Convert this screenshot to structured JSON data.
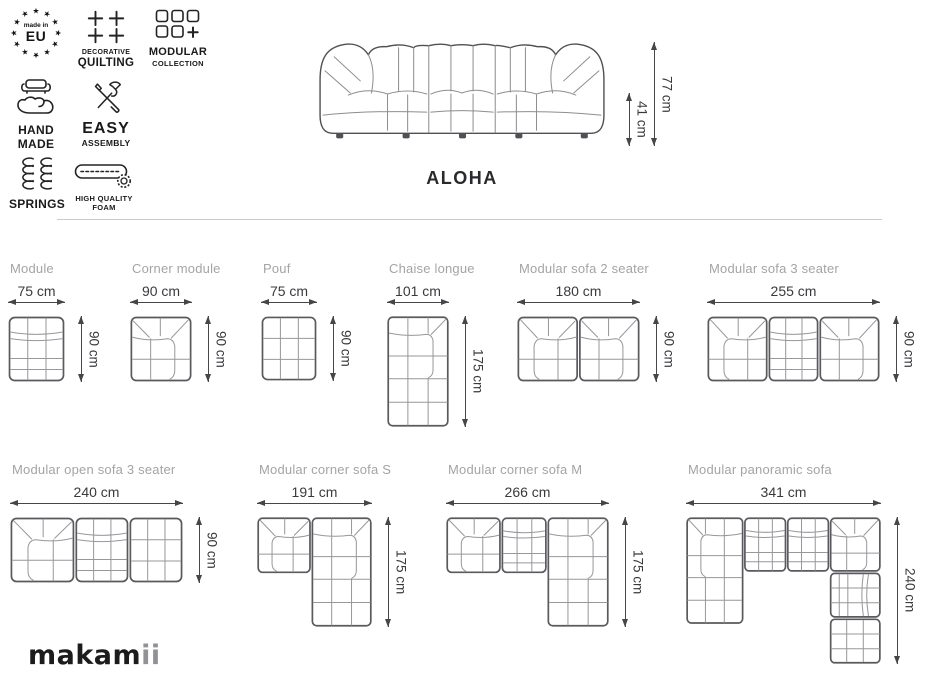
{
  "brand": {
    "logo_main": "makam",
    "logo_suffix": "ii"
  },
  "hero": {
    "product_name": "ALOHA",
    "total_height": "77 cm",
    "seat_height": "41 cm"
  },
  "badges": [
    {
      "name": "made-in-eu",
      "top": "made in",
      "main": "EU"
    },
    {
      "name": "decorative-quilting",
      "line1": "DECORATIVE",
      "line2": "QUILTING"
    },
    {
      "name": "modular-collection",
      "line1": "MODULAR",
      "line2": "COLLECTION"
    },
    {
      "name": "hand-made",
      "line1": "HAND",
      "line2": "MADE"
    },
    {
      "name": "easy-assembly",
      "line1": "EASY",
      "line2": "ASSEMBLY"
    },
    {
      "name": "springs",
      "line1": "SPRINGS"
    },
    {
      "name": "high-quality-foam",
      "line1": "HIGH QUALITY",
      "line2": "FOAM"
    }
  ],
  "modules": [
    {
      "label": "Module",
      "width": "75 cm",
      "depth": "90 cm"
    },
    {
      "label": "Corner module",
      "width": "90 cm",
      "depth": "90 cm"
    },
    {
      "label": "Pouf",
      "width": "75 cm",
      "depth": "90 cm"
    },
    {
      "label": "Chaise longue",
      "width": "101 cm",
      "depth": "175 cm"
    },
    {
      "label": "Modular sofa 2 seater",
      "width": "180 cm",
      "depth": "90 cm"
    },
    {
      "label": "Modular sofa 3 seater",
      "width": "255 cm",
      "depth": "90 cm"
    },
    {
      "label": "Modular open sofa 3 seater",
      "width": "240 cm",
      "depth": "90 cm"
    },
    {
      "label": "Modular corner sofa S",
      "width": "191 cm",
      "depth": "175 cm"
    },
    {
      "label": "Modular corner sofa M",
      "width": "266 cm",
      "depth": "175 cm"
    },
    {
      "label": "Modular panoramic sofa",
      "width": "341 cm",
      "depth": "240 cm"
    }
  ],
  "colors": {
    "line_dark": "#59595e",
    "line_light": "#97979c",
    "dimension_text": "#3a3a3e",
    "label_gray": "#a4a4a8",
    "badge_text": "#1a1a1c",
    "divider": "#cbcbcb",
    "logo": "#1c1c1e",
    "logo_suffix": "#919196",
    "background": "#ffffff"
  }
}
